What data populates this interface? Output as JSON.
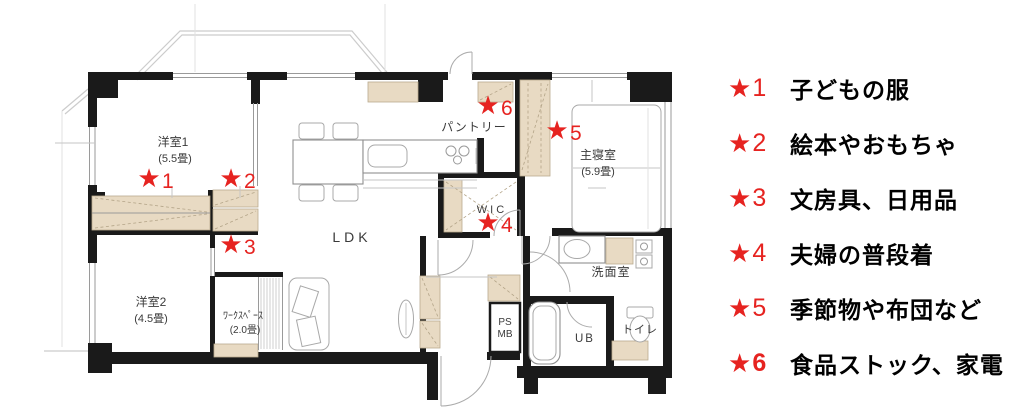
{
  "floorplan": {
    "star_glyph": "★",
    "rooms": [
      {
        "name": "洋室1",
        "size": "(5.5畳)"
      },
      {
        "name": "洋室2",
        "size": "(4.5畳)"
      },
      {
        "name": "ﾜｰｸｽﾍﾟｰｽ",
        "size": "(2.0畳)"
      },
      {
        "name": "LDK",
        "size": ""
      },
      {
        "name": "パントリー",
        "size": ""
      },
      {
        "name": "主寝室",
        "size": "(5.9畳)"
      },
      {
        "name": "WIC",
        "size": ""
      },
      {
        "name": "洗面室",
        "size": ""
      },
      {
        "name": "トイレ",
        "size": ""
      },
      {
        "name": "UB",
        "size": ""
      },
      {
        "name": "PS",
        "size": ""
      },
      {
        "name": "MB",
        "size": ""
      }
    ],
    "markers": [
      {
        "number": "1"
      },
      {
        "number": "2"
      },
      {
        "number": "3"
      },
      {
        "number": "4"
      },
      {
        "number": "5"
      },
      {
        "number": "6"
      }
    ]
  },
  "legend": {
    "items": [
      {
        "star": "★",
        "number": "1",
        "label": "子どもの服"
      },
      {
        "star": "★",
        "number": "2",
        "label": "絵本やおもちゃ"
      },
      {
        "star": "★",
        "number": "3",
        "label": "文房具、日用品"
      },
      {
        "star": "★",
        "number": "4",
        "label": "夫婦の普段着"
      },
      {
        "star": "★",
        "number": "5",
        "label": "季節物や布団など"
      },
      {
        "star": "★",
        "number": "6",
        "label": "食品ストック、家電"
      }
    ]
  },
  "colors": {
    "marker_red": "#e62320",
    "wall_black": "#1a1a1a",
    "closet_tan": "#e8dac3",
    "legend_text": "#000000"
  }
}
